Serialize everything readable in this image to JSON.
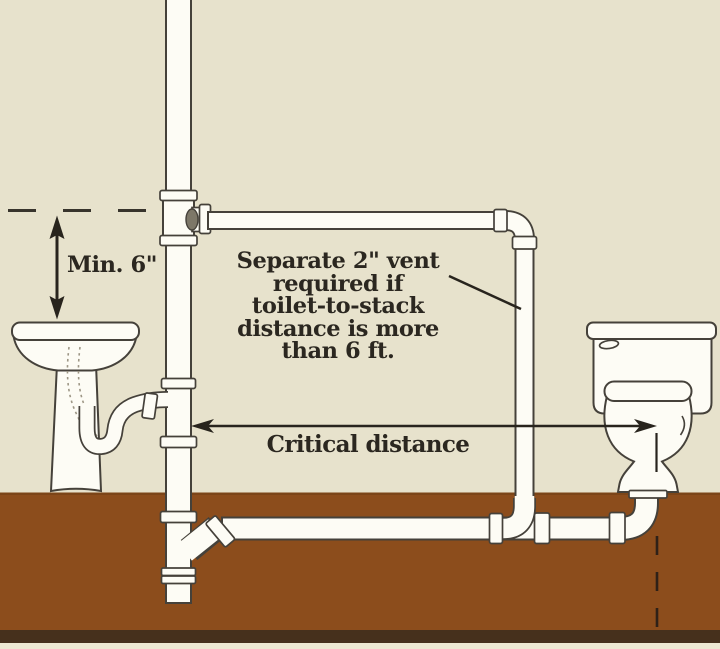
{
  "labels": {
    "min_height": "Min. 6\"",
    "vent_note_lines": [
      "Separate 2\" vent",
      "required if",
      "toilet-to-stack",
      "distance is more",
      "than 6 ft."
    ],
    "critical_distance": "Critical distance"
  },
  "colors": {
    "wall": "#E7E2CC",
    "soil": "#8C4D1C",
    "soil_edge": "#7C4518",
    "soil_dark_band": "#46301C",
    "bottom_strip": "#EDE8D2",
    "pipe_fill": "#FDFCF5",
    "pipe_outline": "#45413A",
    "text": "#2B2720",
    "arrow": "#28241D"
  },
  "elements": {
    "stack": "soil-stack-pipe",
    "vent": "vent-pipe",
    "sink": "pedestal-sink",
    "trap": "p-trap",
    "toilet": "toilet",
    "drain": "building-drain-pipe",
    "closet_bend": "closet-bend"
  }
}
